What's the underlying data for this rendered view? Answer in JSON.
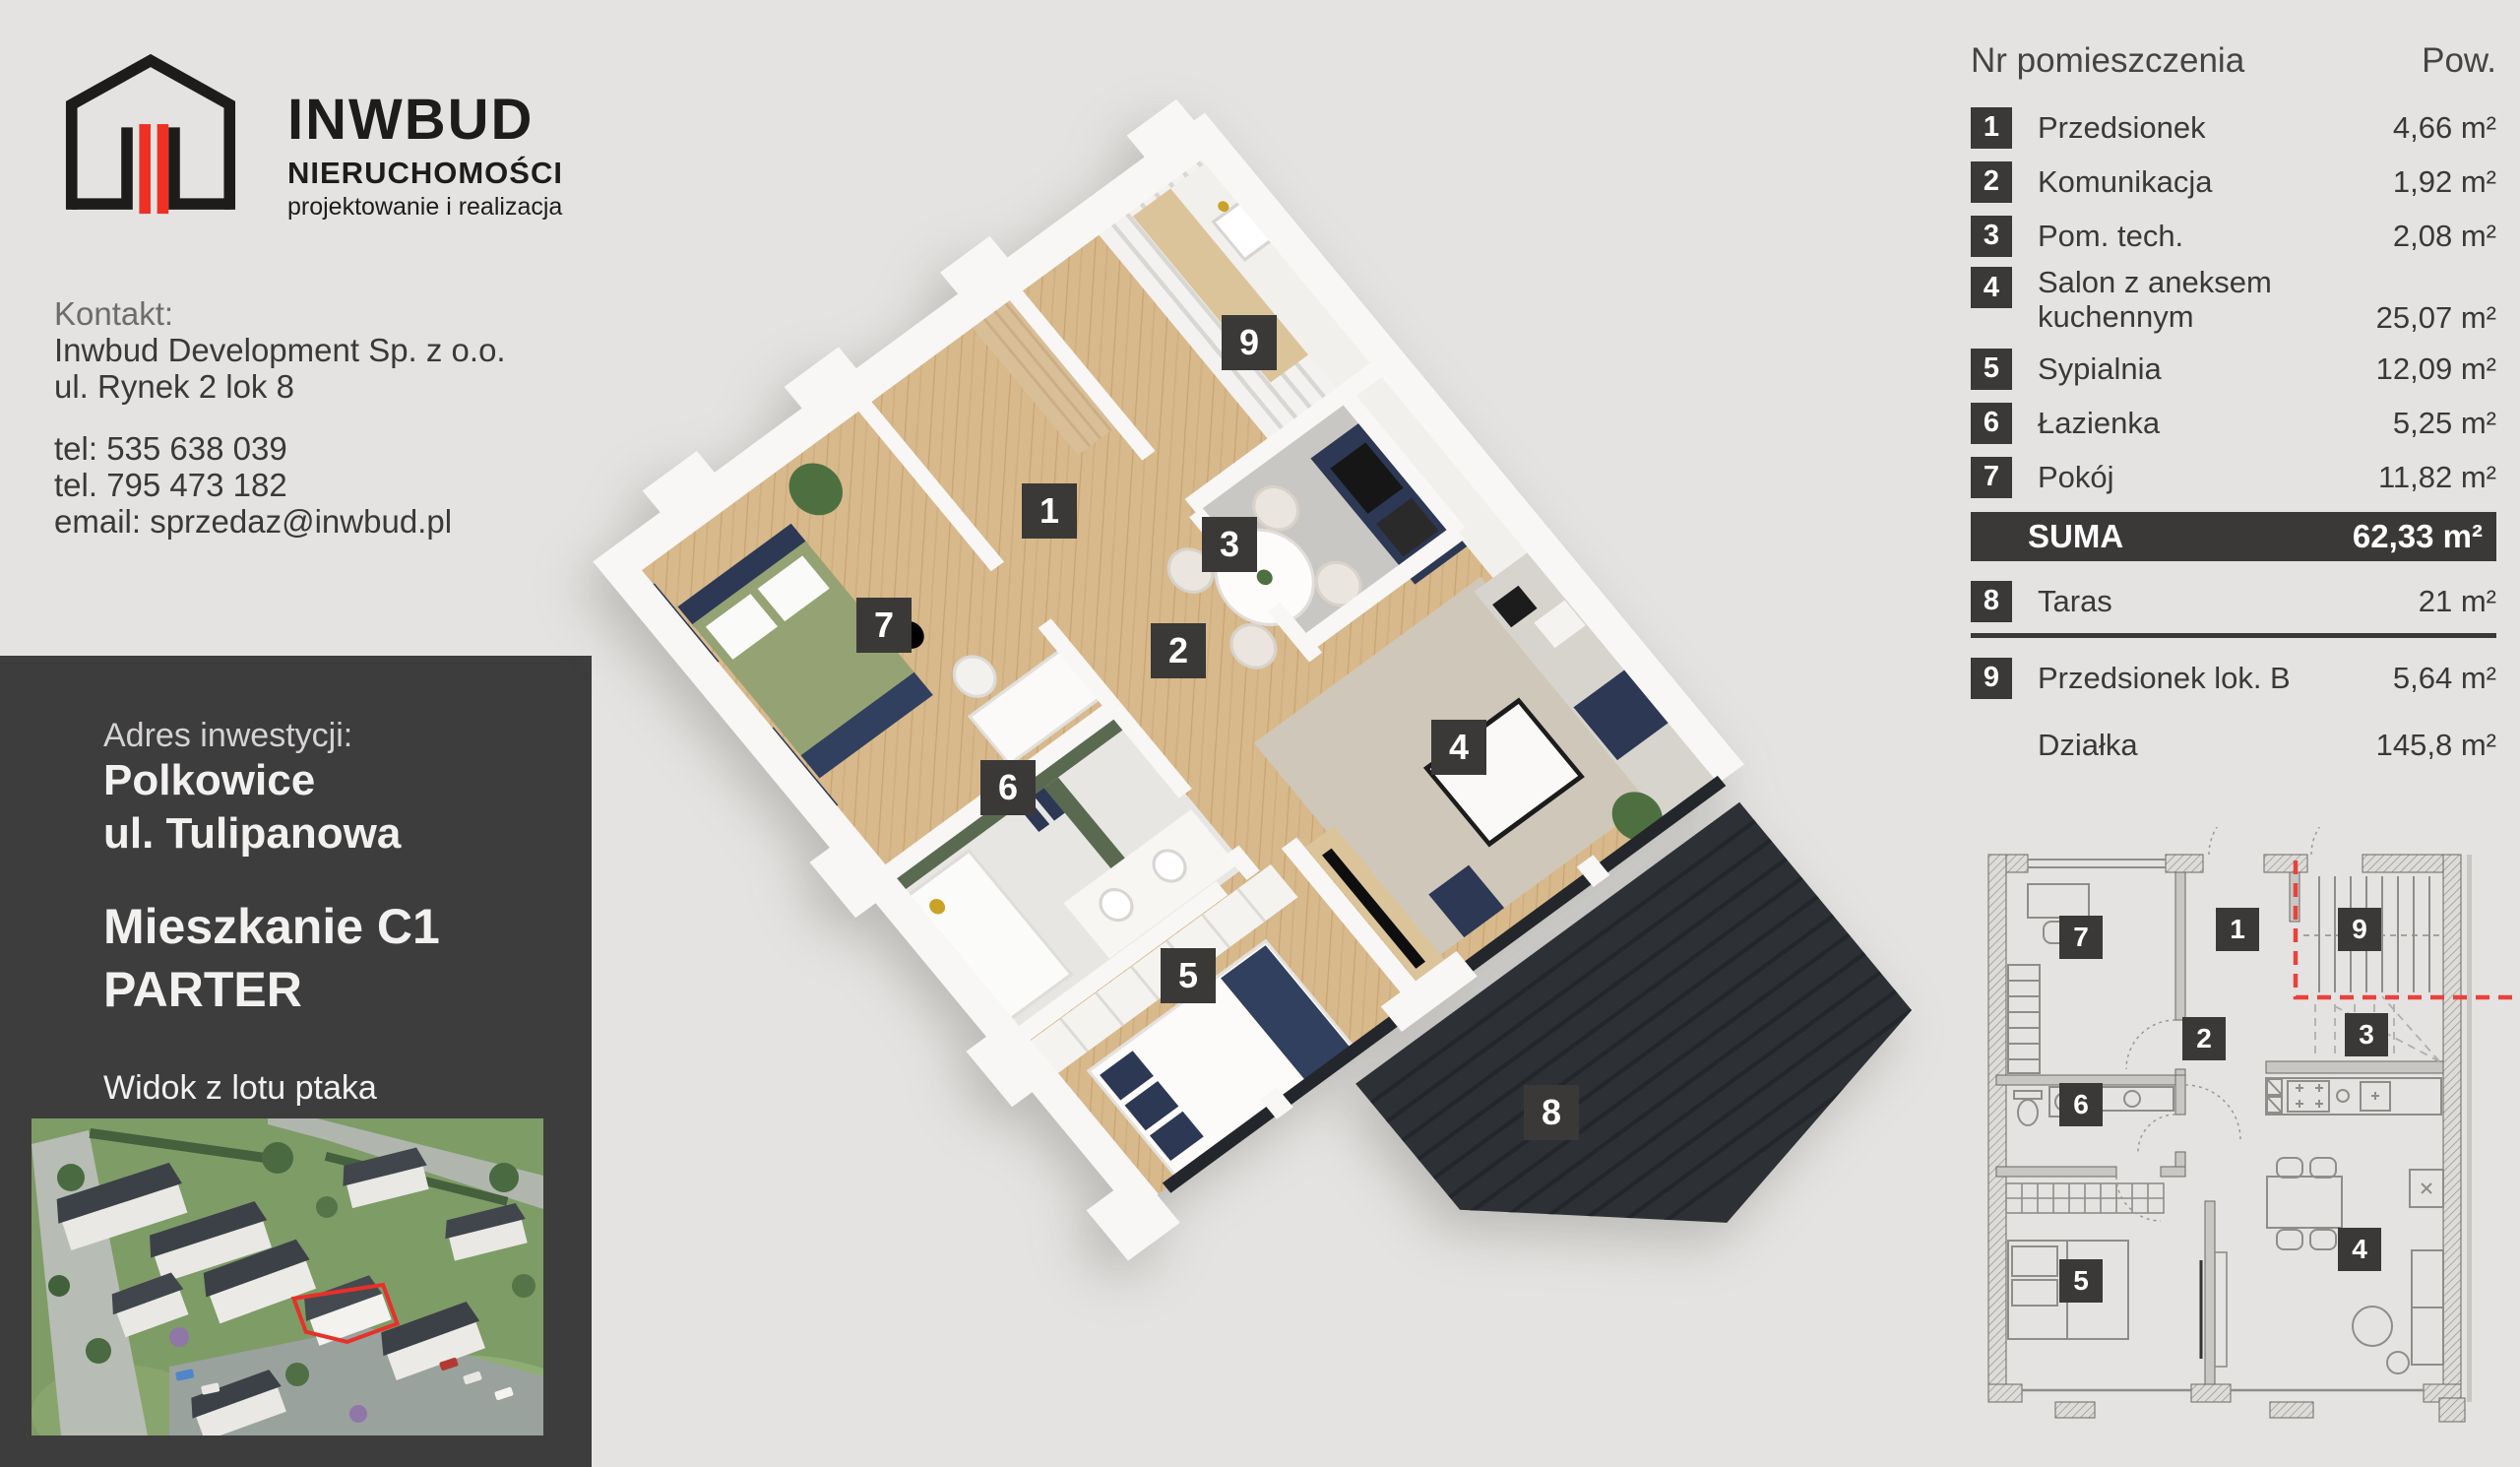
{
  "brand": {
    "title": "INWBUD",
    "subtitle": "NIERUCHOMOŚCI",
    "tagline": "projektowanie i realizacja"
  },
  "contact": {
    "label": "Kontakt:",
    "company": "Inwbud Development Sp. z o.o.",
    "address": "ul. Rynek 2 lok 8",
    "phone1": "tel: 535 638 039",
    "phone2": "tel. 795 473 182",
    "email": "email: sprzedaz@inwbud.pl"
  },
  "investment": {
    "label": "Adres inwestycji:",
    "city": "Polkowice",
    "street": "ul. Tulipanowa",
    "unit": "Mieszkanie C1",
    "level": "PARTER",
    "aerial_caption": "Widok z lotu ptaka"
  },
  "area_table": {
    "col_number": "Nr pomieszczenia",
    "col_area": "Pow.",
    "rows": [
      {
        "no": "1",
        "name": "Przedsionek",
        "area": "4,66 m²"
      },
      {
        "no": "2",
        "name": "Komunikacja",
        "area": "1,92 m²"
      },
      {
        "no": "3",
        "name": "Pom. tech.",
        "area": "2,08 m²"
      },
      {
        "no": "4",
        "name": "Salon z aneksem",
        "name2": "kuchennym",
        "area": "25,07 m²"
      },
      {
        "no": "5",
        "name": "Sypialnia",
        "area": "12,09 m²"
      },
      {
        "no": "6",
        "name": "Łazienka",
        "area": "5,25 m²"
      },
      {
        "no": "7",
        "name": "Pokój",
        "area": "11,82 m²"
      }
    ],
    "suma_label": "SUMA",
    "suma_area": "62,33 m²",
    "taras": {
      "no": "8",
      "name": "Taras",
      "area": "21 m²"
    },
    "lok_b": {
      "no": "9",
      "name": "Przedsionek lok. B",
      "area": "5,64 m²"
    },
    "dzialka": {
      "name": "Działka",
      "area": "145,8 m²"
    }
  },
  "plan_labels": [
    "1",
    "2",
    "3",
    "4",
    "5",
    "6",
    "7",
    "8",
    "9"
  ],
  "colors": {
    "accent_red": "#ee3124",
    "dark": "#3a3938",
    "panel_dark": "#3e3d3d",
    "background": "#e4e3e1",
    "wood_floor": "#d8b98c",
    "navy": "#2c3854",
    "terrace_dark": "#2d3136",
    "bath_green": "#5a6a50"
  }
}
